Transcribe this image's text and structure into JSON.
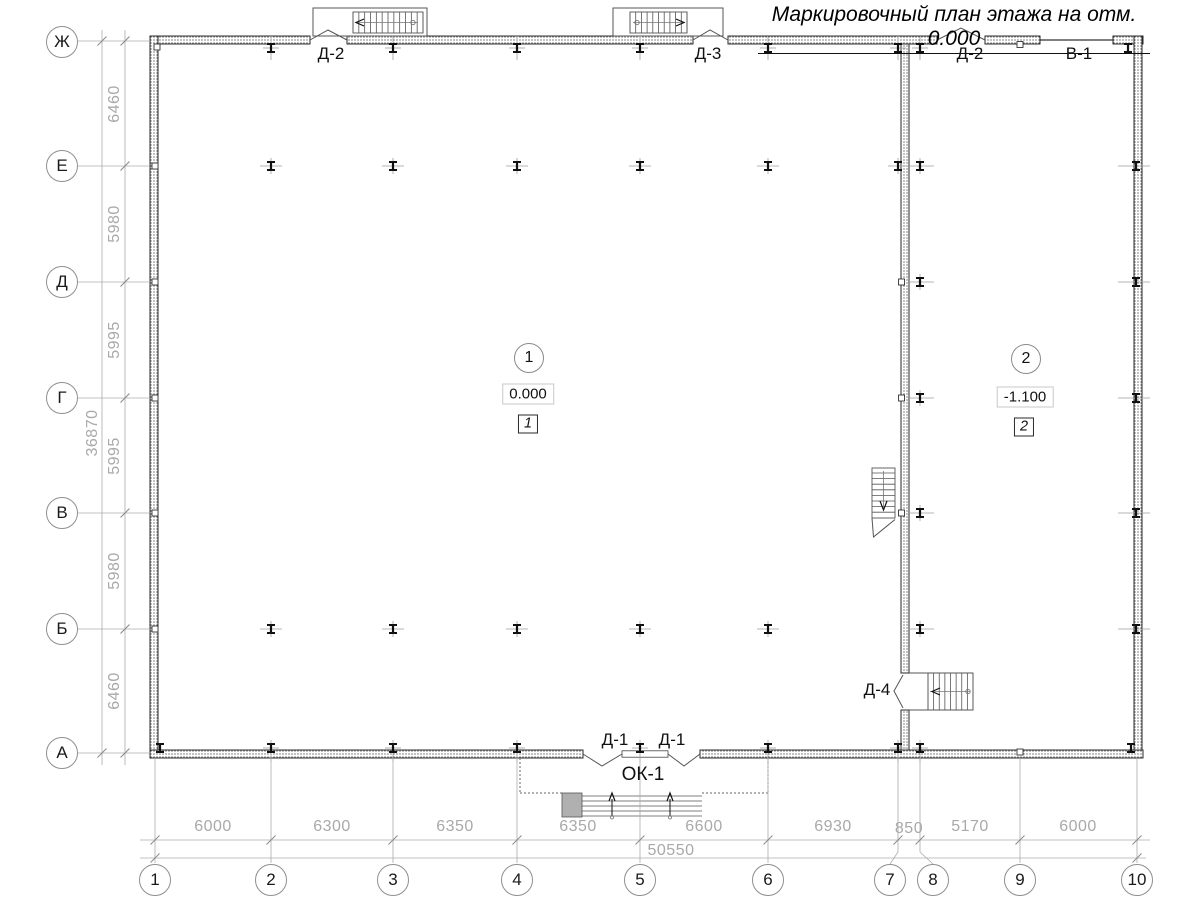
{
  "title": "Маркировочный план этажа на отм. 0.000",
  "grid": {
    "row_labels": [
      "Ж",
      "Е",
      "Д",
      "Г",
      "В",
      "Б",
      "А"
    ],
    "col_labels": [
      "1",
      "2",
      "3",
      "4",
      "5",
      "6",
      "7",
      "8",
      "9",
      "10"
    ]
  },
  "dims": {
    "left": [
      "6460",
      "5980",
      "5995",
      "5995",
      "5980",
      "6460"
    ],
    "left_total": "36870",
    "bottom": [
      "6000",
      "6300",
      "6350",
      "6350",
      "6600",
      "6930",
      "850",
      "5170",
      "6000"
    ],
    "bottom_total": "50550"
  },
  "rooms": [
    {
      "number": "1",
      "elevation": "0.000",
      "mark": "1"
    },
    {
      "number": "2",
      "elevation": "-1.100",
      "mark": "2"
    }
  ],
  "openings": {
    "top_door_left": "Д-2",
    "top_door_mid": "Д-3",
    "top_door_right": "Д-2",
    "top_gate": "В-1",
    "bottom_door_left": "Д-1",
    "bottom_door_right": "Д-1",
    "bottom_window": "ОК-1",
    "side_door": "Д-4"
  },
  "colors": {
    "line": "#2a2a2a",
    "dim": "#a9a9a9",
    "label": "#111111"
  }
}
